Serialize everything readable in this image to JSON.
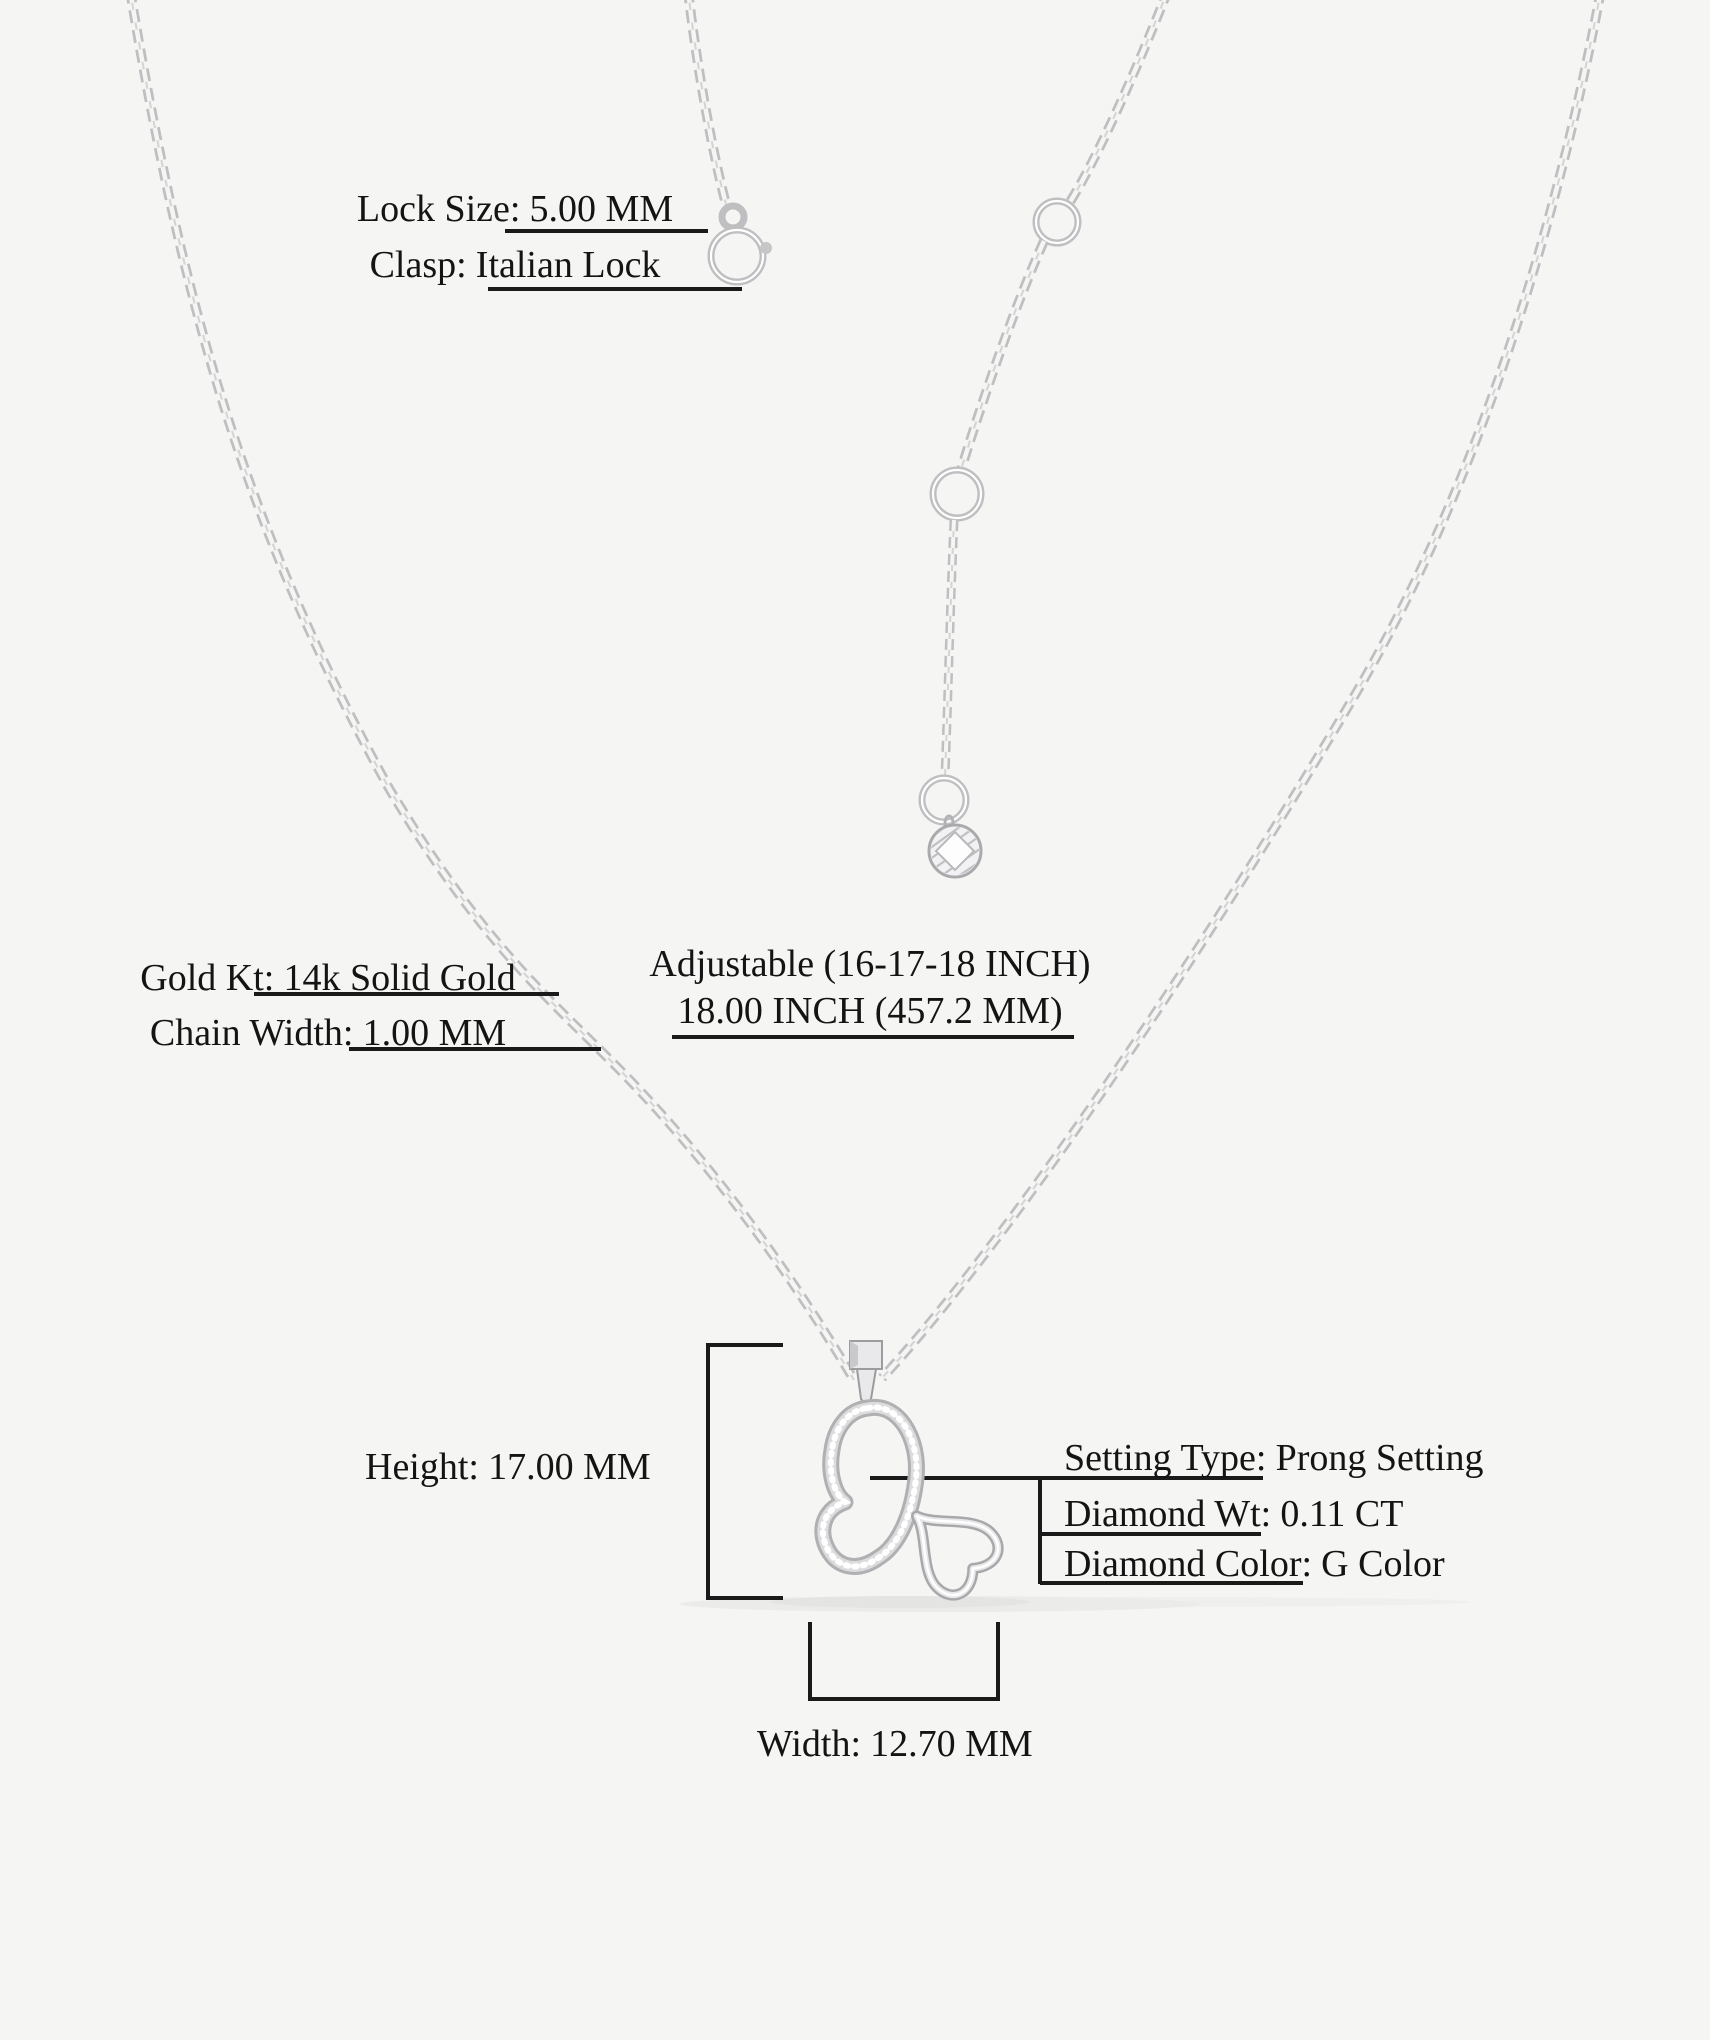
{
  "colors": {
    "background": "#f5f5f4",
    "text": "#141414",
    "annotation_line": "#1a1a1a",
    "metal_light": "#e9e9eb",
    "metal_mid": "#bfbfc1",
    "metal_dark": "#9c9c9e"
  },
  "specs": {
    "lock_size": {
      "label": "Lock Size:",
      "value": "5.00 MM"
    },
    "clasp": {
      "label": "Clasp:",
      "value": "Italian Lock"
    },
    "gold_kt": {
      "label": "Gold Kt:",
      "value": "14k Solid Gold"
    },
    "chain_width": {
      "label": "Chain Width:",
      "value": "1.00 MM"
    },
    "adjustable": {
      "line1": "Adjustable (16-17-18 INCH)",
      "line2": "18.00 INCH (457.2 MM)"
    },
    "height": {
      "label": "Height:",
      "value": "17.00 MM"
    },
    "setting_type": {
      "label": "Setting Type:",
      "value": "Prong Setting"
    },
    "diamond_wt": {
      "label": "Diamond Wt:",
      "value": "0.11 CT"
    },
    "diamond_color": {
      "label": "Diamond Color:",
      "value": "G Color"
    },
    "width": {
      "label": "Width:",
      "value": "12.70 MM"
    }
  }
}
